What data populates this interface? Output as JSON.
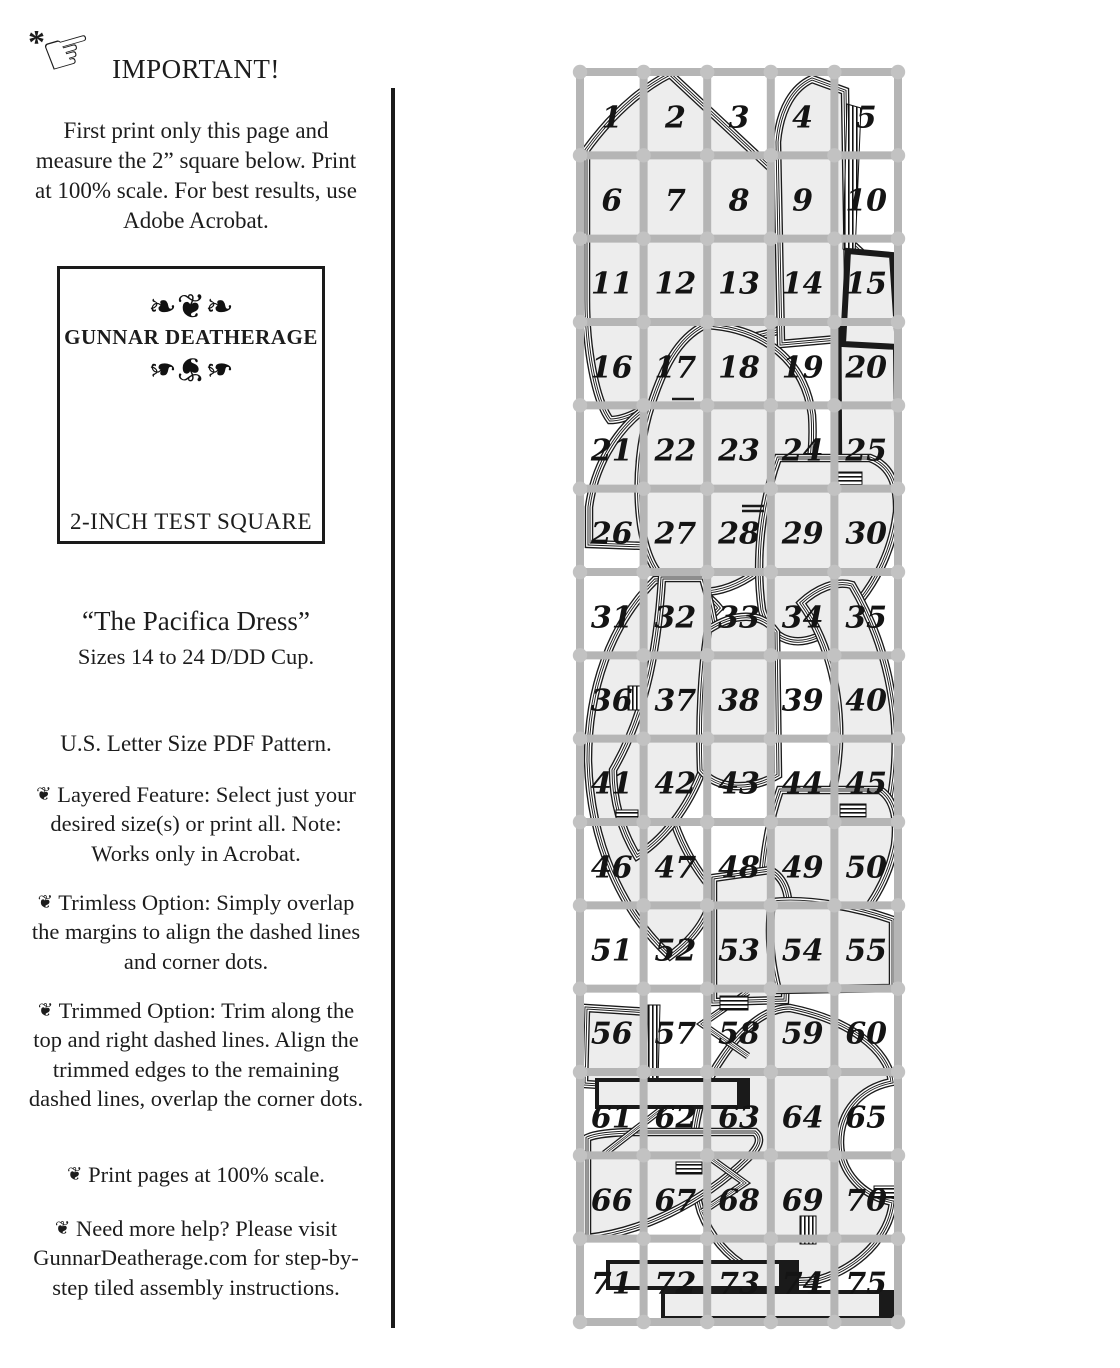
{
  "left_column": {
    "asterisk_icon": "*",
    "manicule_icon": "☞",
    "heading": "IMPORTANT!",
    "intro": "First print only this page and measure the 2” square below. Print at 100% scale. For best results, use Adobe Acrobat.",
    "test_square": {
      "ornament_top": "❧❦❧",
      "brand": "GUNNAR DEATHERAGE",
      "ornament_bottom": "❧❦❧",
      "label": "2-INCH TEST SQUARE",
      "label_color": "#6e7e8e"
    },
    "title": "“The Pacifica Dress”",
    "subtitle": "Sizes 14 to 24 D/DD Cup.",
    "format_line": "U.S. Letter Size PDF Pattern.",
    "bullet_glyph": "❦",
    "bullets": [
      "Layered Feature: Select just your desired size(s) or print all. Note: Works only in Acrobat.",
      "Trimless Option: Simply overlap the margins to align the dashed lines and corner dots.",
      "Trimmed Option: Trim along the top and right dashed lines. Align the trimmed edges to the remaining dashed lines, overlap the corner dots.",
      "Print pages at 100% scale.",
      "Need more help? Please visit GunnarDeatherage.com for step-by-step tiled assembly instructions."
    ]
  },
  "tile_map": {
    "columns": 5,
    "rows": 15,
    "grid_color": "#b5b5b5",
    "piece_fill": "#ededed",
    "outline_color": "#1a1a1a",
    "tile_numbers": [
      "1",
      "2",
      "3",
      "4",
      "5",
      "6",
      "7",
      "8",
      "9",
      "10",
      "11",
      "12",
      "13",
      "14",
      "15",
      "16",
      "17",
      "18",
      "19",
      "20",
      "21",
      "22",
      "23",
      "24",
      "25",
      "26",
      "27",
      "28",
      "29",
      "30",
      "31",
      "32",
      "33",
      "34",
      "35",
      "36",
      "37",
      "38",
      "39",
      "40",
      "41",
      "42",
      "43",
      "44",
      "45",
      "46",
      "47",
      "48",
      "49",
      "50",
      "51",
      "52",
      "53",
      "54",
      "55",
      "56",
      "57",
      "58",
      "59",
      "60",
      "61",
      "62",
      "63",
      "64",
      "65",
      "66",
      "67",
      "68",
      "69",
      "70",
      "71",
      "72",
      "73",
      "74",
      "75"
    ]
  }
}
